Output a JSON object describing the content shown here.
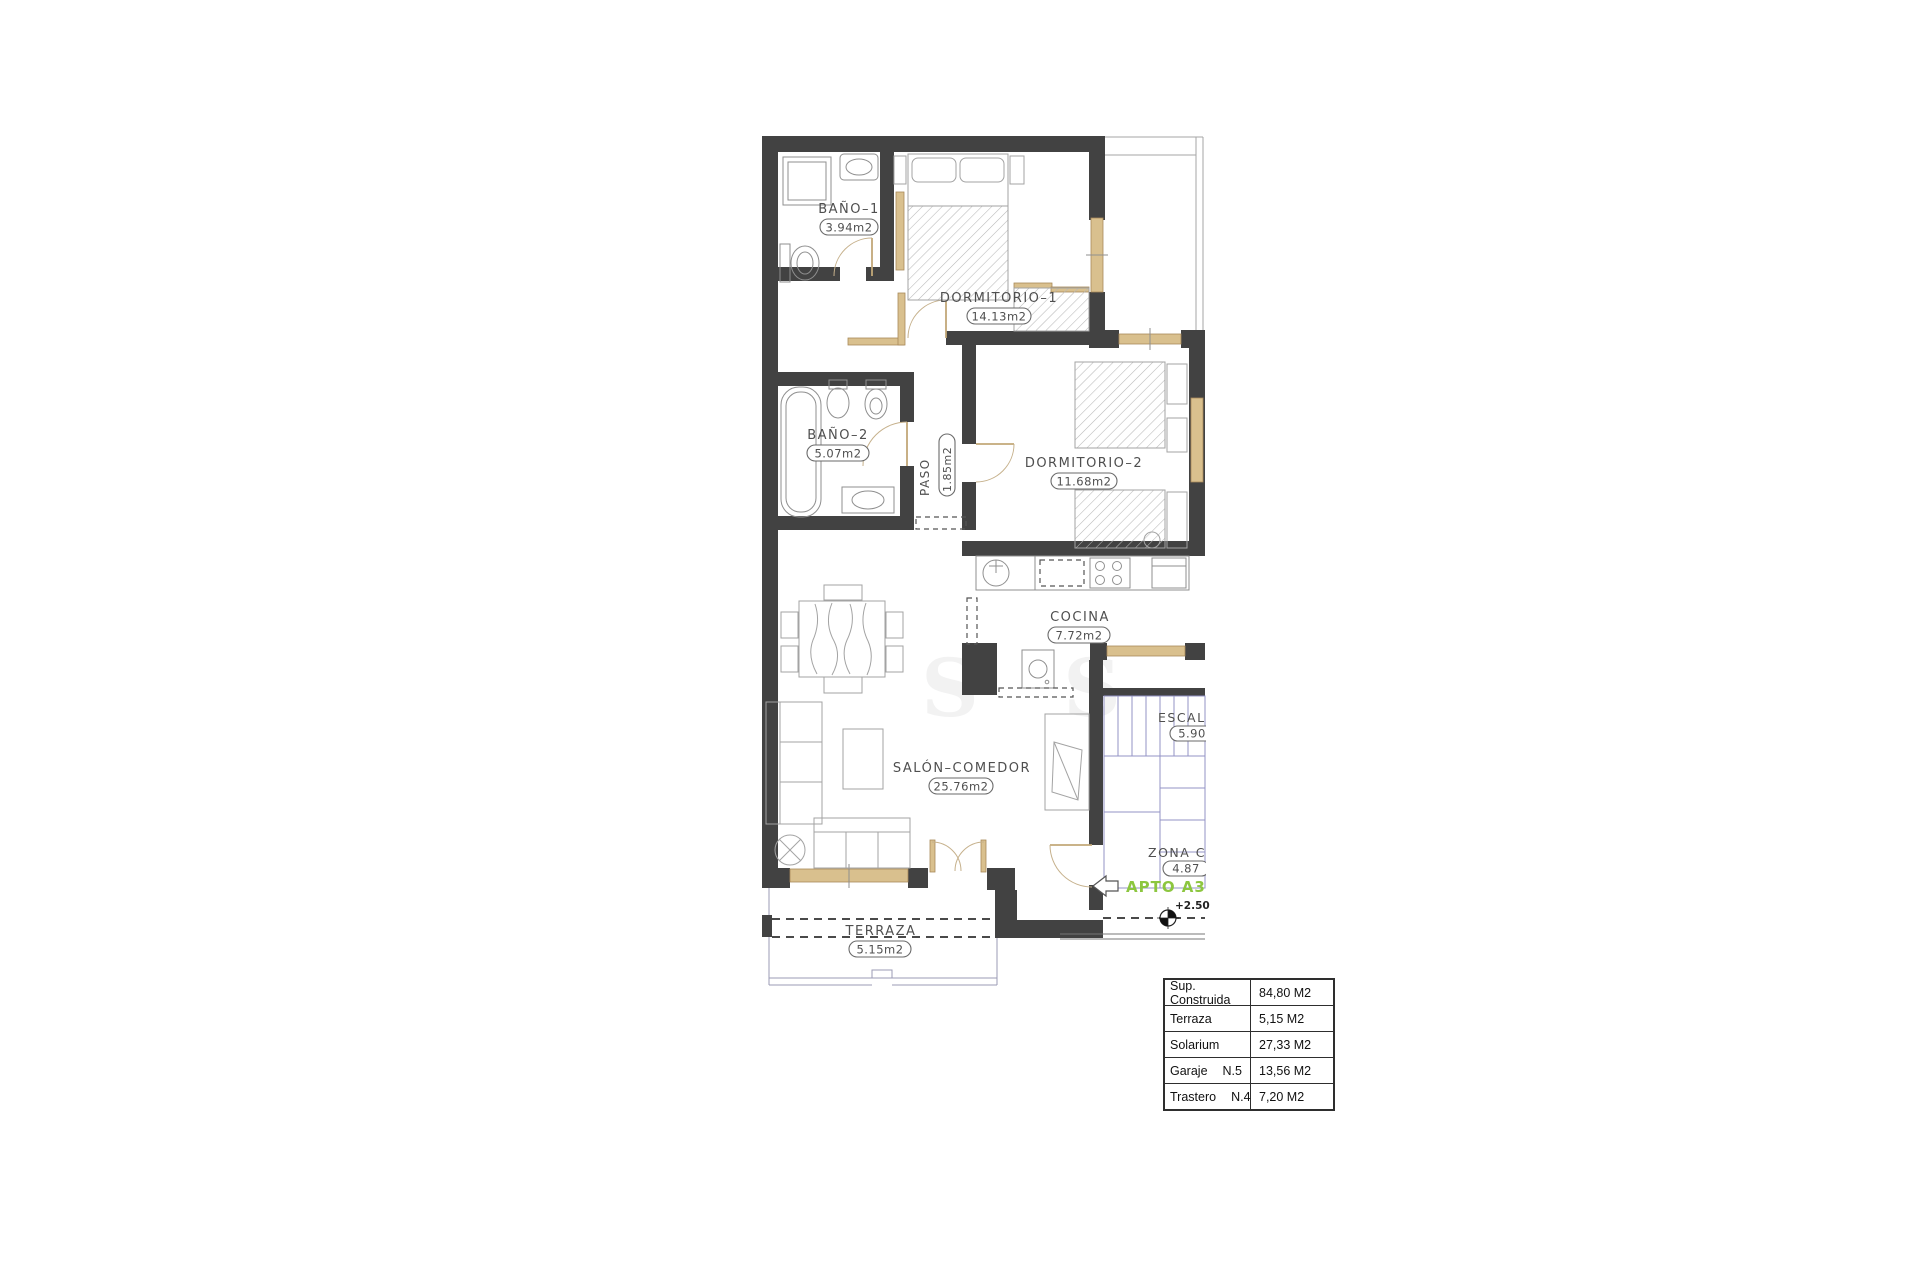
{
  "plan": {
    "rooms": {
      "bano1": {
        "name": "BAÑO–1",
        "area": "3.94m2"
      },
      "dormitorio1": {
        "name": "DORMITORIO–1",
        "area": "14.13m2"
      },
      "bano2": {
        "name": "BAÑO–2",
        "area": "5.07m2"
      },
      "paso": {
        "name": "PASO",
        "area": "1.85m2"
      },
      "dormitorio2": {
        "name": "DORMITORIO–2",
        "area": "11.68m2"
      },
      "cocina": {
        "name": "COCINA",
        "area": "7.72m2"
      },
      "salon": {
        "name": "SALÓN–COMEDOR",
        "area": "25.76m2"
      },
      "terraza": {
        "name": "TERRAZA",
        "area": "5.15m2"
      },
      "escalera": {
        "name": "ESCAL",
        "area": "5.90"
      },
      "zona_comun": {
        "name": "ZONA C",
        "area": "4.87"
      }
    },
    "apartment_label": "APTO A3",
    "level_mark": "+2.50",
    "watermark": [
      "S",
      "S"
    ],
    "colors": {
      "wall": "#424242",
      "joinery_tan": "#d9c08e",
      "stairs_blue": "#9393c6",
      "accent_green": "#8cc63f"
    }
  },
  "summary_table": {
    "rows": [
      {
        "label": "Sup. Construida",
        "lot": "",
        "value": "84,80 M2"
      },
      {
        "label": "Terraza",
        "lot": "",
        "value": "5,15 M2"
      },
      {
        "label": "Solarium",
        "lot": "",
        "value": "27,33 M2"
      },
      {
        "label": "Garaje",
        "lot": "N.5",
        "value": "13,56 M2"
      },
      {
        "label": "Trastero",
        "lot": "N.4",
        "value": "7,20 M2"
      }
    ]
  }
}
